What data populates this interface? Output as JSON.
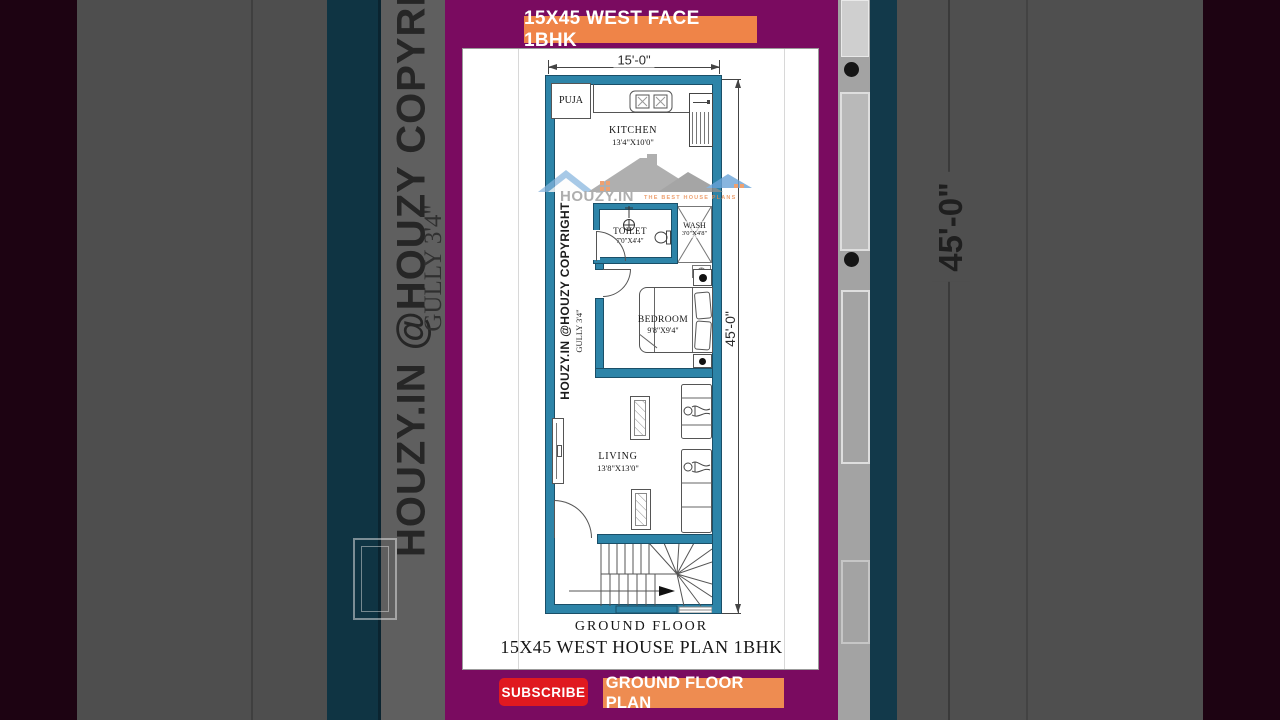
{
  "top_banner": {
    "label": "15X45 WEST FACE 1BHK"
  },
  "video": {
    "footer_title": "GROUND FLOOR",
    "footer_subtitle": "15X45 WEST HOUSE PLAN 1BHK",
    "subscribe_label": "SUBSCRIBE",
    "plan_button_label": "GROUND FLOOR PLAN"
  },
  "plan": {
    "width_dim": "15'-0\"",
    "height_dim": "45'-0\"",
    "copyright_text": "HOUZY.IN @HOUZY COPYRIGHT",
    "gully_label": "GULLY 3'4\"",
    "rooms": {
      "puja": {
        "name": "PUJA"
      },
      "kitchen": {
        "name": "KITCHEN",
        "size": "13'4\"X10'0\""
      },
      "toilet": {
        "name": "TOILET",
        "size": "7'0\"X4'4\""
      },
      "wash": {
        "name": "WASH",
        "size": "3'0\"X4'8\""
      },
      "bedroom": {
        "name": "BEDROOM",
        "size": "9'8\"X9'4\""
      },
      "living": {
        "name": "LIVING",
        "size": "13'8\"X13'0\""
      }
    },
    "watermark": {
      "brand": "HOUZY.IN",
      "tagline": "THE BEST HOUSE PLANS"
    }
  },
  "background": {
    "left_copyright": "HOUZY.IN @HOUZY COPYRIGHT",
    "left_gully": "GULLY 3'4\"",
    "right_dimension": "45'-0\""
  },
  "colors": {
    "wall_teal": "#2d84a8",
    "banner_orange": "#ef8448",
    "plan_button_orange": "#ee8c51",
    "subscribe_red": "#e0191f",
    "purple": "#7a0b60"
  }
}
